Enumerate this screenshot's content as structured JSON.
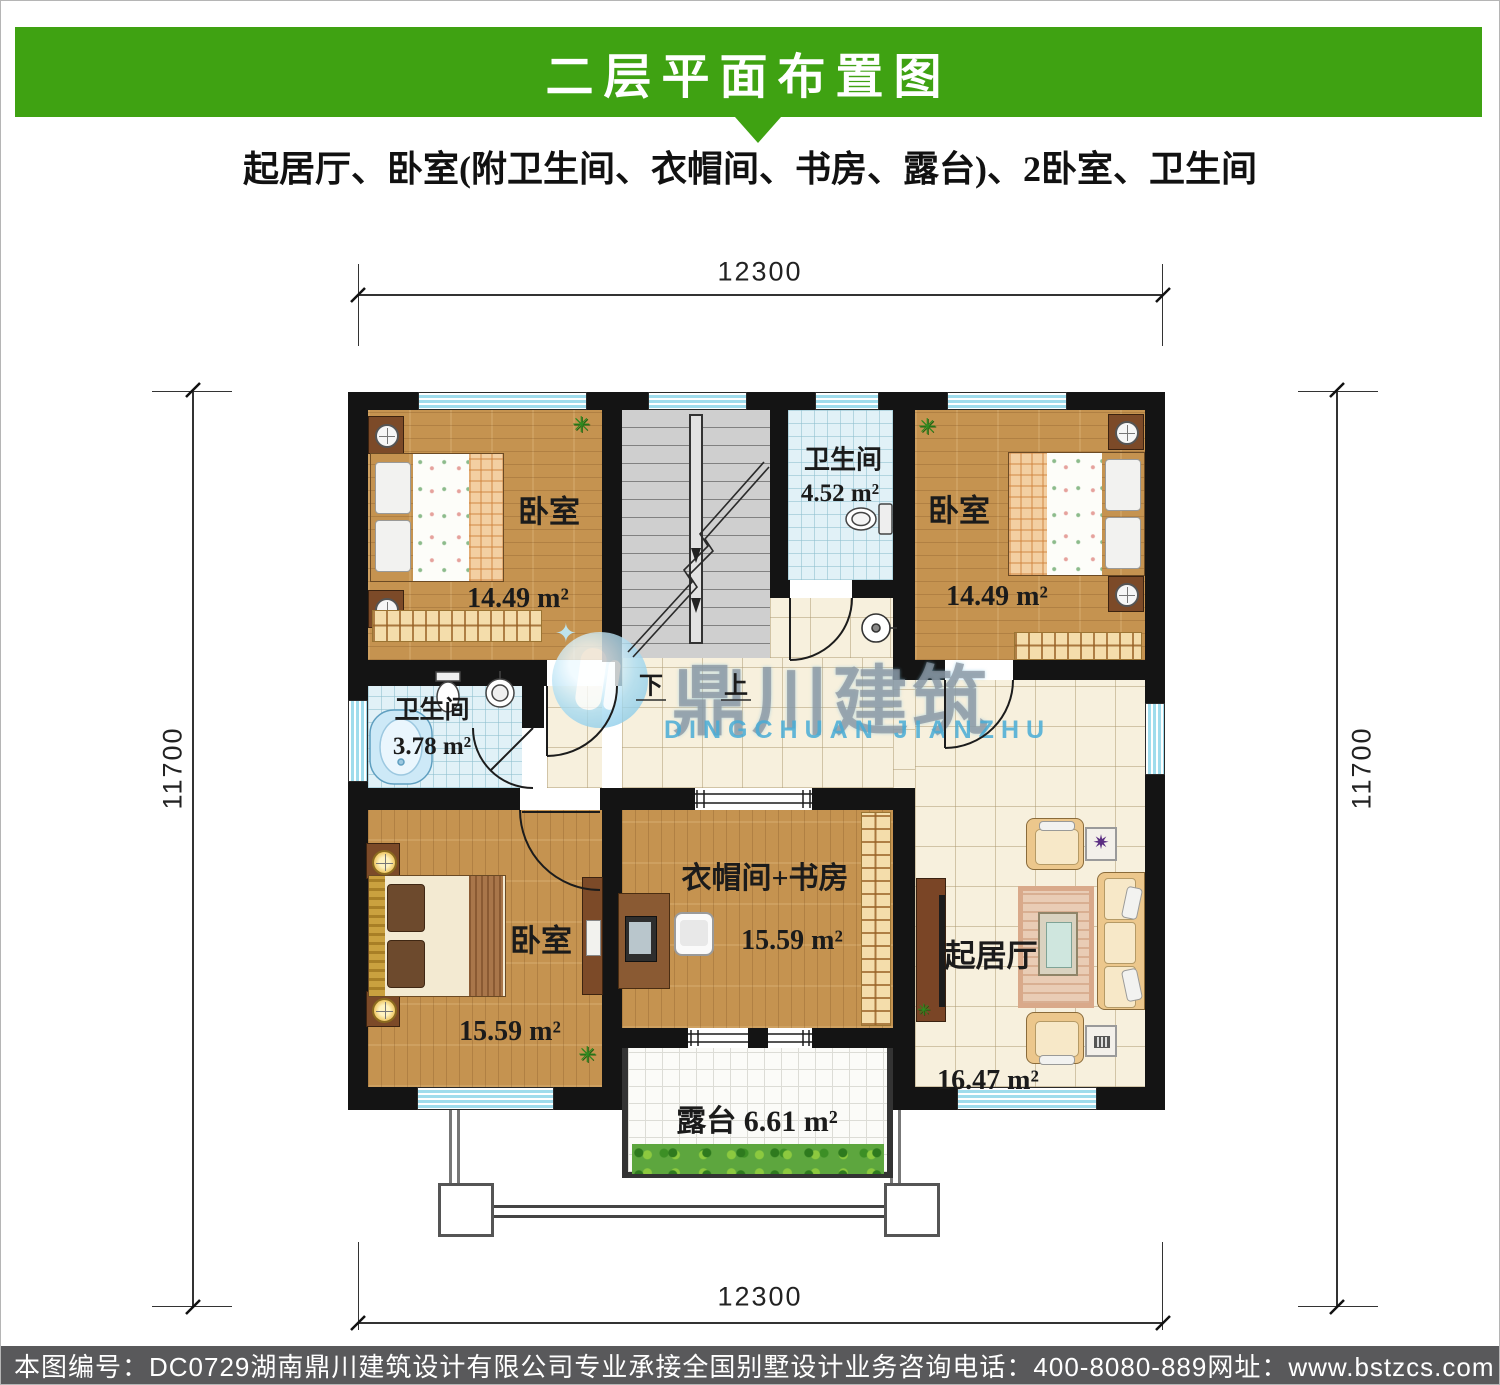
{
  "header": {
    "title": "二层平面布置图",
    "subtitle": "起居厅、卧室(附卫生间、衣帽间、书房、露台)、2卧室、卫生间",
    "banner_color": "#3FA212"
  },
  "dimensions": {
    "top": "12300",
    "bottom": "12300",
    "left": "11700",
    "right": "11700"
  },
  "rooms": {
    "bedroom_tl": {
      "name": "卧室",
      "area": "14.49 m²"
    },
    "bath_top": {
      "name": "卫生间",
      "area": "4.52 m²"
    },
    "bedroom_tr": {
      "name": "卧室",
      "area": "14.49 m²"
    },
    "bath_mid": {
      "name": "卫生间",
      "area": "3.78 m²"
    },
    "bedroom_bl": {
      "name": "卧室",
      "area": "15.59 m²"
    },
    "closet_study": {
      "name": "衣帽间+书房",
      "area": "15.59 m²"
    },
    "living": {
      "name": "起居厅",
      "area": "16.47 m²"
    },
    "terrace": {
      "name": "露台",
      "area": "6.61 m²"
    }
  },
  "stairs": {
    "down_label": "下",
    "up_label": "上"
  },
  "watermark": {
    "cn": "鼎川建筑",
    "en": "DINGCHUAN JIANZHU"
  },
  "footer": {
    "drawing_no": "本图编号：DC0729",
    "company": "湖南鼎川建筑设计有限公司专业承接全国别墅设计业务",
    "phone": "咨询电话：400-8080-889",
    "website": "网址：www.bstzcs.com",
    "bg_color": "#59595B"
  }
}
